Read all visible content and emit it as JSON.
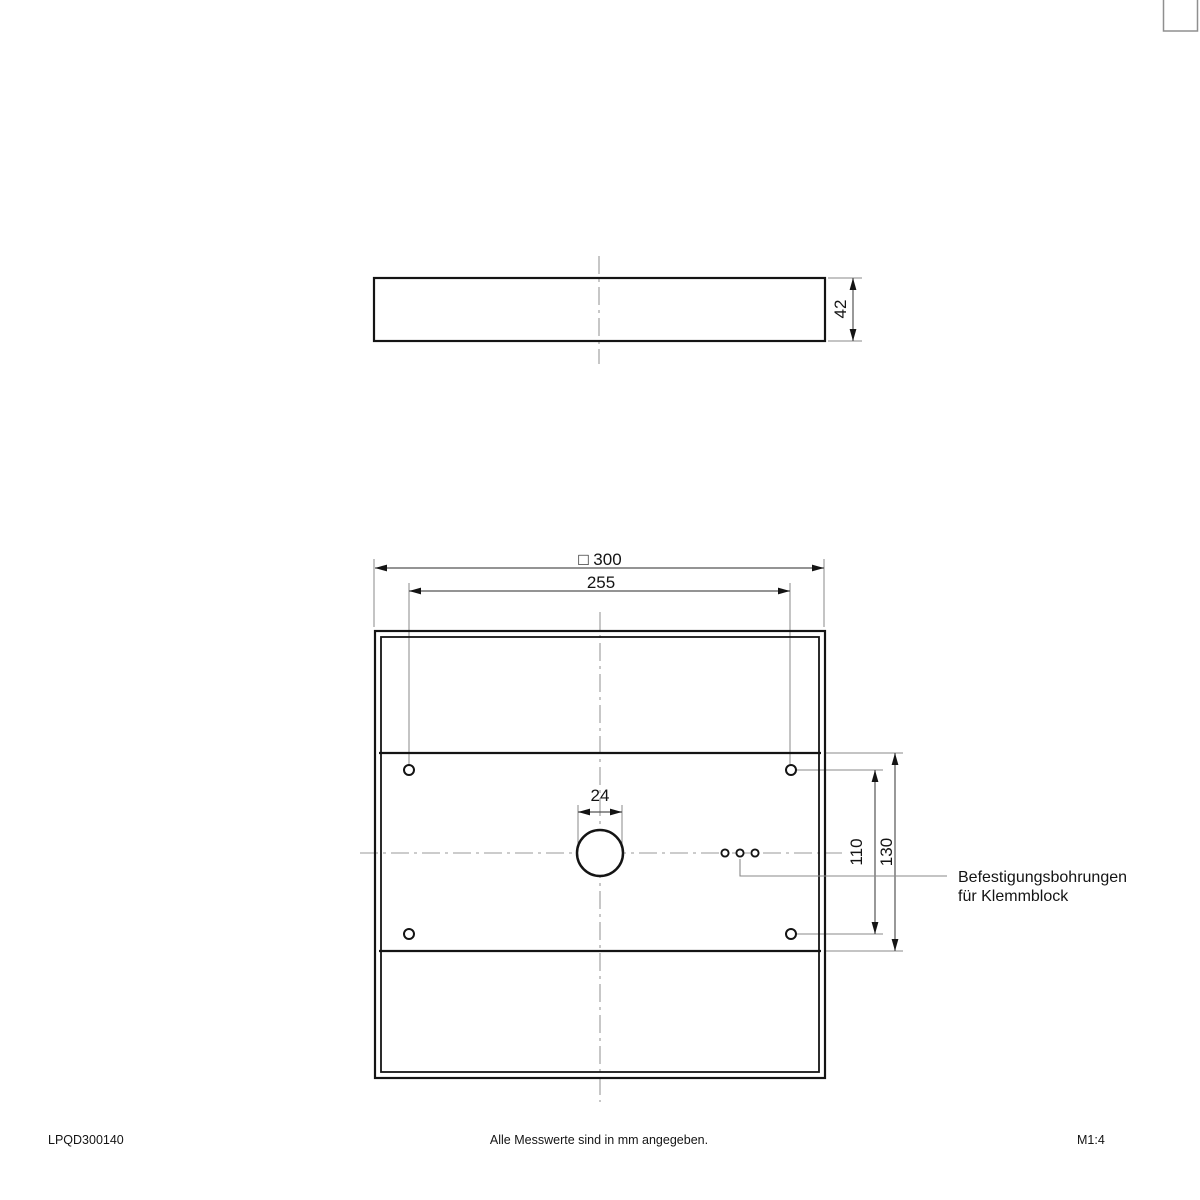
{
  "page": {
    "background": "#ffffff",
    "line_color": "#141414",
    "dimension_color": "#555555",
    "extension_color": "#8a8a8a",
    "centerline_color": "#999999"
  },
  "dimensions": {
    "overall_square": "□ 300",
    "mounting_hole_spacing_horizontal": "255",
    "center_hole_diameter": "24",
    "profile_height": "42",
    "mounting_hole_spacing_vertical": "110",
    "panel_section_height": "130"
  },
  "annotation": {
    "line1": "Befestigungsbohrungen",
    "line2": "für Klemmblock"
  },
  "footer": {
    "product_code": "LPQD300140",
    "units_note": "Alle Messwerte sind in mm angegeben.",
    "scale": "M1:4"
  }
}
